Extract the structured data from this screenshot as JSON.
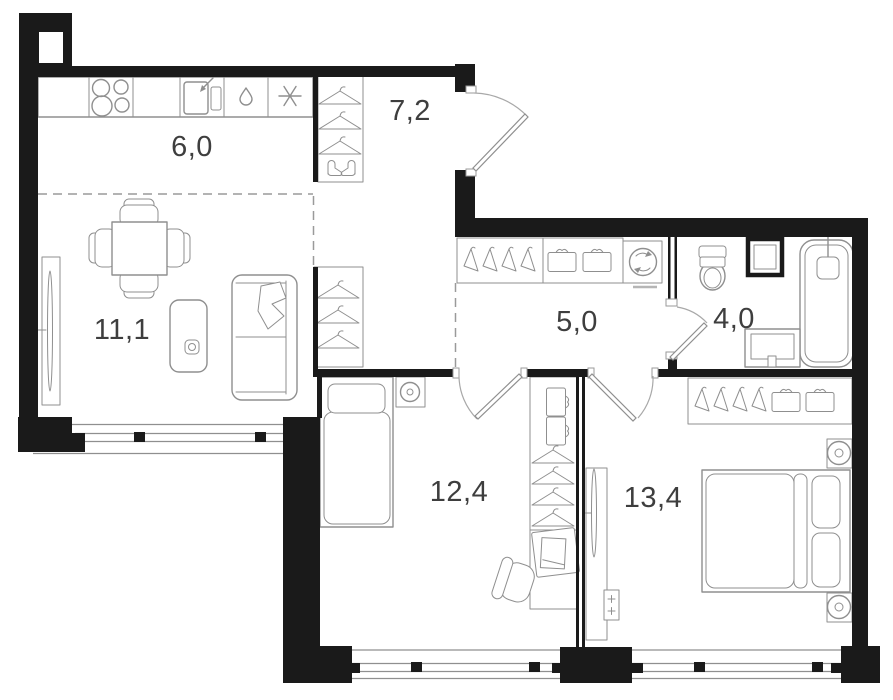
{
  "document": {
    "type": "apartment-floor-plan"
  },
  "colors": {
    "wall": "#1a1a1a",
    "furniture": "#8f8f8f",
    "label": "#3e3e3e",
    "dashed": "#9a9a9a",
    "background": "#ffffff"
  },
  "rooms": [
    {
      "id": "kitchen",
      "label": "6,0"
    },
    {
      "id": "hallway",
      "label": "7,2"
    },
    {
      "id": "living",
      "label": "11,1"
    },
    {
      "id": "corridor",
      "label": "5,0"
    },
    {
      "id": "bathroom",
      "label": "4,0"
    },
    {
      "id": "bedroom-1",
      "label": "12,4"
    },
    {
      "id": "bedroom-2",
      "label": "13,4"
    }
  ],
  "icons": [
    "stove-burners-icon",
    "kitchen-sink-icon",
    "dishwasher-droplet-icon",
    "fridge-snowflake-icon",
    "hanger-icon",
    "shoes-icon",
    "storage-box-icon",
    "washing-machine-icon",
    "toilet-icon",
    "ventilation-shaft-icon",
    "bathtub-icon",
    "washbasin-icon",
    "dining-table-icon",
    "chair-icon",
    "sofa-icon",
    "tv-icon",
    "floor-unit-icon",
    "single-bed-icon",
    "double-bed-icon",
    "nightstand-lamp-icon",
    "desk-icon",
    "desk-chair-icon",
    "radiator-icon",
    "door-swing-icon",
    "window"
  ]
}
